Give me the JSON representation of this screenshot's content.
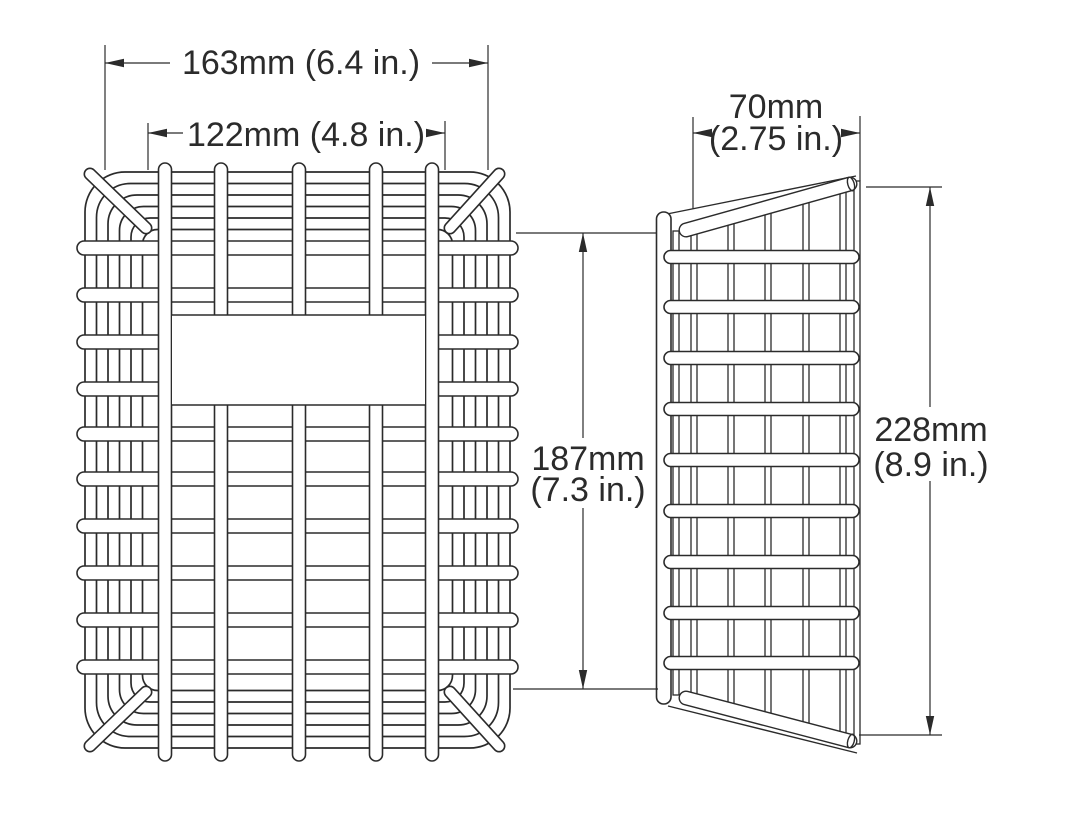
{
  "drawing": {
    "kind": "wire-guard-two-view-technical-drawing",
    "views": {
      "front": "front-view",
      "side": "side-view"
    }
  },
  "colors": {
    "line": "#2b2b2b",
    "background": "#ffffff"
  },
  "dimensions": {
    "outer_width": {
      "text": "163mm (6.4 in.)"
    },
    "inner_width": {
      "text": "122mm (4.8 in.)"
    },
    "front_height": {
      "mm": "187mm",
      "inch": "(7.3 in.)"
    },
    "depth": {
      "mm": "70mm",
      "inch": "(2.75 in.)"
    },
    "side_height": {
      "mm": "228mm",
      "inch": "(8.9 in.)"
    }
  }
}
